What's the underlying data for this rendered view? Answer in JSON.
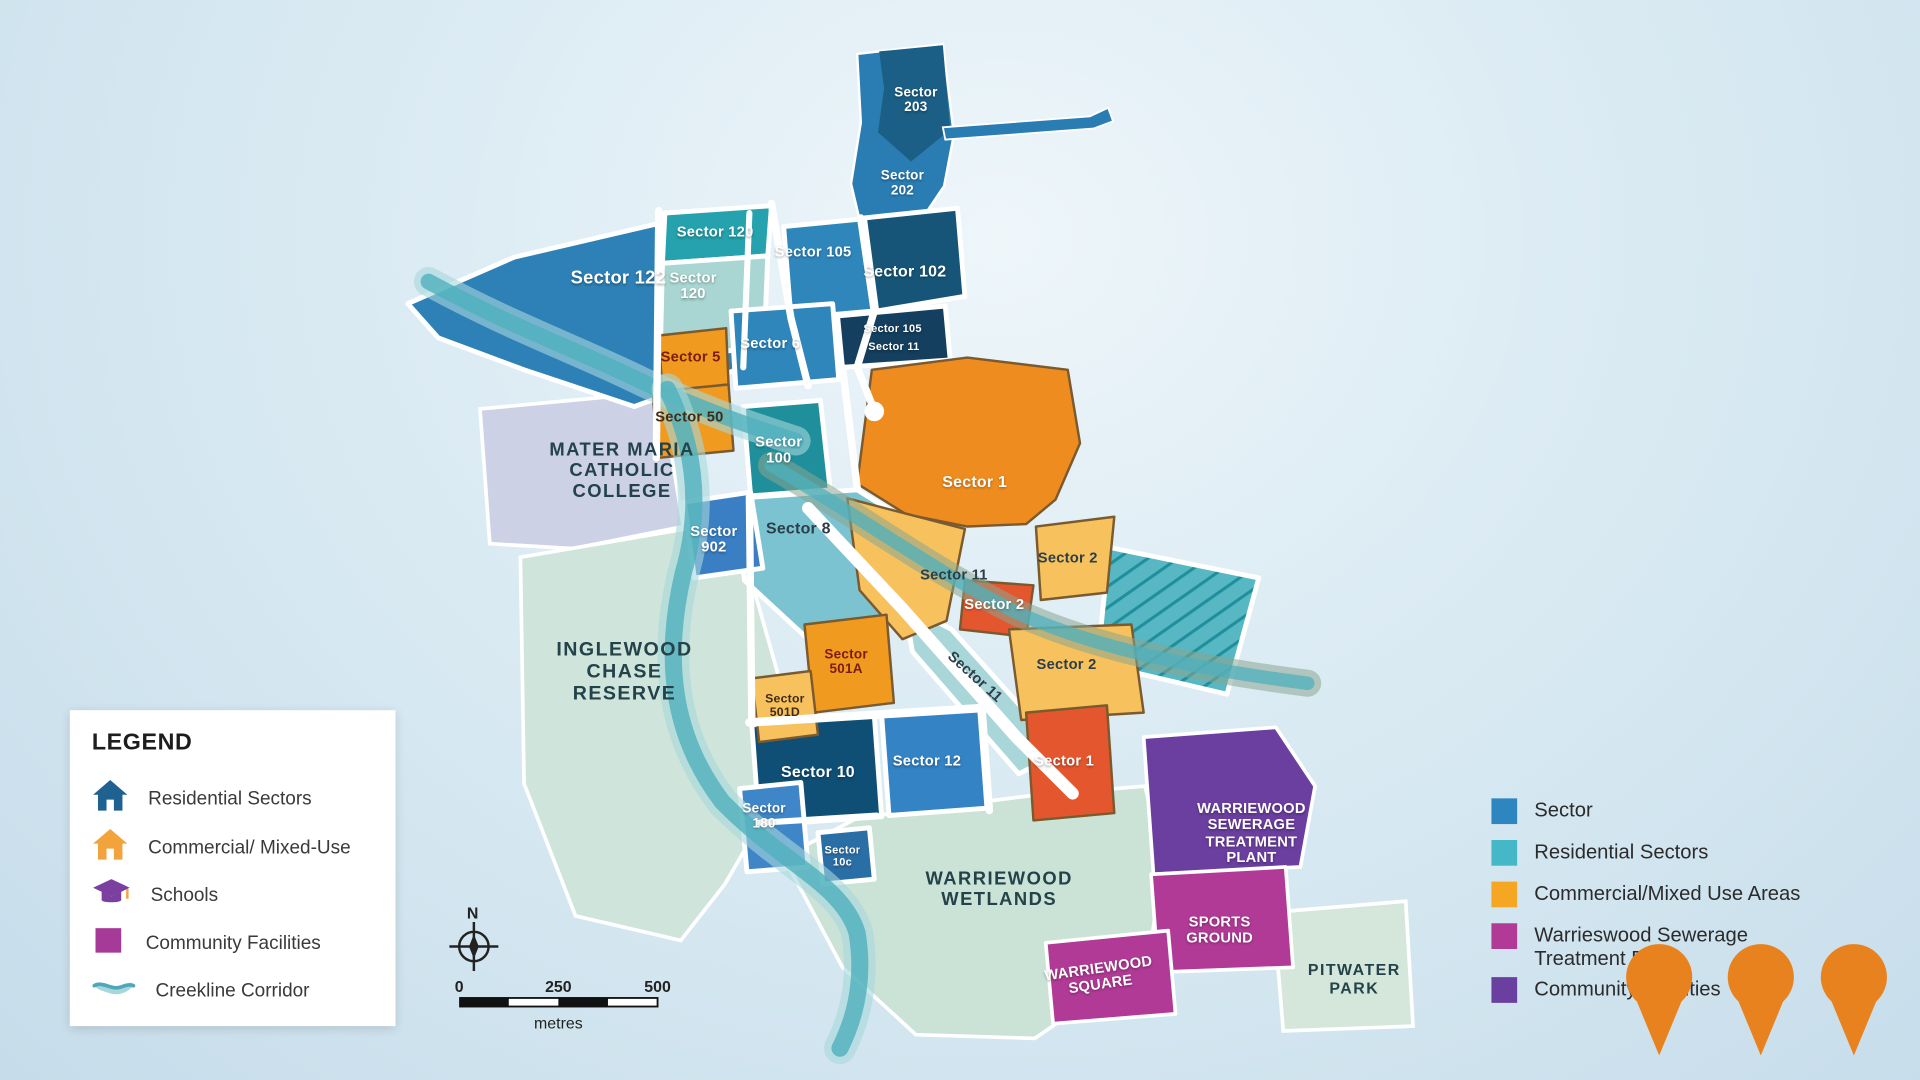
{
  "palette": {
    "background": "#d8e9f2",
    "blue_mid": "#2e81b6",
    "blue_navy": "#165577",
    "blue_dark_box": "#143f5e",
    "teal": "#25a2ad",
    "teal_dark": "#1f8f9c",
    "teal_light": "#a9d6d2",
    "blue_sector12": "#3383c5",
    "orange": "#f19a20",
    "yellow": "#f7c25e",
    "red_orange": "#e4572e",
    "magenta": "#b13a96",
    "purple": "#6b3fa0",
    "lavender": "#cdd1e6",
    "reserve_green": "#cfe4da",
    "creek": "#4fb0bd",
    "road": "#ffffff",
    "pin_orange": "#e8821e"
  },
  "map": {
    "labels": {
      "sector203": "Sector\n203",
      "sector202": "Sector\n202",
      "sector120_strip": "Sector 120",
      "sector120": "Sector\n120",
      "sector122": "Sector 122",
      "sector105": "Sector 105",
      "sector102": "Sector 102",
      "sector105b": "Sector 105",
      "sector11b": "Sector 11",
      "sector6": "Sector 6",
      "sector5": "Sector 5",
      "sector50": "Sector 50",
      "sector100": "Sector\n100",
      "sector8": "Sector 8",
      "sector902": "Sector\n902",
      "sector1": "Sector 1",
      "sector11y": "Sector 11",
      "sector2_red": "Sector 2",
      "sector2_east": "Sector 2",
      "sector2_south": "Sector 2",
      "sector11_road": "Sector 11",
      "sector501a": "Sector\n501A",
      "sector501d": "Sector\n501D",
      "sector10": "Sector 10",
      "sector180": "Sector\n180",
      "sector12": "Sector 12",
      "sector10c": "Sector\n10c",
      "sector1_low": "Sector 1",
      "mater_maria": "MATER MARIA\nCATHOLIC\nCOLLEGE",
      "inglewood": "INGLEWOOD\nCHASE\nRESERVE",
      "wetlands": "WARRIEWOOD\nWETLANDS",
      "sewerage": "WARRIEWOOD\nSEWERAGE\nTREATMENT\nPLANT",
      "sports_ground": "SPORTS\nGROUND",
      "warriewood_square": "WARRIEWOOD\nSQUARE",
      "pitwater_park": "PITWATER\nPARK"
    }
  },
  "legend": {
    "title": "LEGEND",
    "items": [
      {
        "icon": "house-icon",
        "label": "Residential Sectors"
      },
      {
        "icon": "house-icon",
        "label": "Commercial/ Mixed-Use"
      },
      {
        "icon": "graduation-cap-icon",
        "label": "Schools"
      },
      {
        "icon": "square-icon",
        "label": "Community Facilities"
      },
      {
        "icon": "wave-icon",
        "label": "Creekline Corridor"
      }
    ]
  },
  "right_legend": {
    "items": [
      {
        "color": "#2e86c1",
        "label": "Sector"
      },
      {
        "color": "#45b8c8",
        "label": "Residential Sectors"
      },
      {
        "color": "#f5a623",
        "label": "Commercial/Mixed Use Areas"
      },
      {
        "color": "#b13a96",
        "label": "Warrieswood Sewerage\nTreatment Plant"
      },
      {
        "color": "#6b3fa0",
        "label": "Community Facilities"
      }
    ]
  },
  "scale_bar": {
    "north": "N",
    "tick0": "0",
    "tick250": "250",
    "tick500": "500",
    "unit": "metres"
  },
  "markers": {
    "count": 3,
    "icon": "map-pin-icon",
    "color": "#e8821e"
  }
}
